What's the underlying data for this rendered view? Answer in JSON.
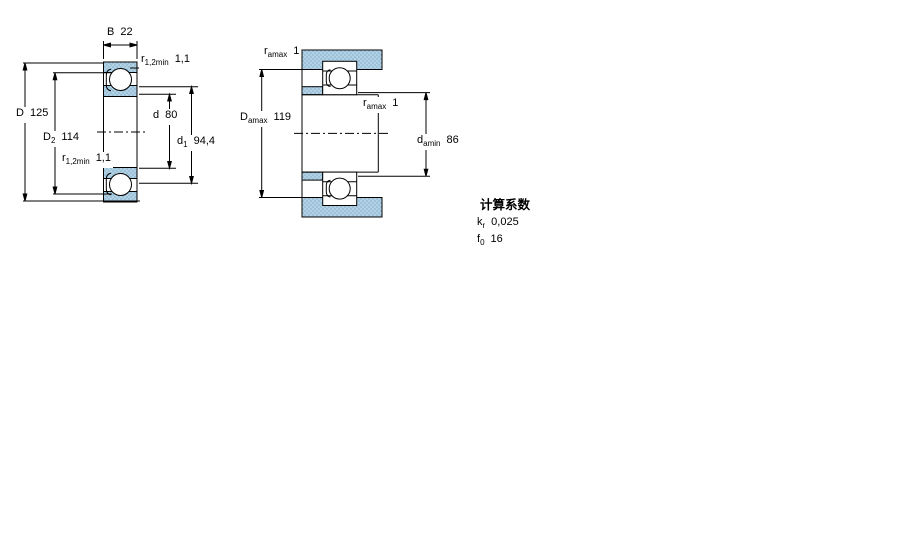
{
  "colors": {
    "steel_fill": "#9cc2da",
    "steel_dot": "#d8eaf4",
    "line": "#000000",
    "background": "#ffffff"
  },
  "drawing": {
    "left_view": {
      "B": {
        "symbol": "B",
        "sub": "",
        "value": "22"
      },
      "r_top": {
        "symbol": "r",
        "sub": "1,2min",
        "value": "1,1"
      },
      "D": {
        "symbol": "D",
        "sub": "",
        "value": "125"
      },
      "D2": {
        "symbol": "D",
        "sub": "2",
        "value": "114"
      },
      "r_bottom": {
        "symbol": "r",
        "sub": "1,2min",
        "value": "1,1"
      },
      "d": {
        "symbol": "d",
        "sub": "",
        "value": "80"
      },
      "d1": {
        "symbol": "d",
        "sub": "1",
        "value": "94,4"
      }
    },
    "right_view": {
      "r_amax_top": {
        "symbol": "r",
        "sub": "amax",
        "value": "1"
      },
      "D_amax": {
        "symbol": "D",
        "sub": "amax",
        "value": "119"
      },
      "r_amax_mid": {
        "symbol": "r",
        "sub": "amax",
        "value": "1"
      },
      "d_amin": {
        "symbol": "d",
        "sub": "amin",
        "value": "86"
      }
    }
  },
  "calculation_factors": {
    "title": "计算系数",
    "kr": {
      "symbol": "k",
      "sub": "r",
      "value": "0,025"
    },
    "f0": {
      "symbol": "f",
      "sub": "0",
      "value": "16"
    }
  }
}
